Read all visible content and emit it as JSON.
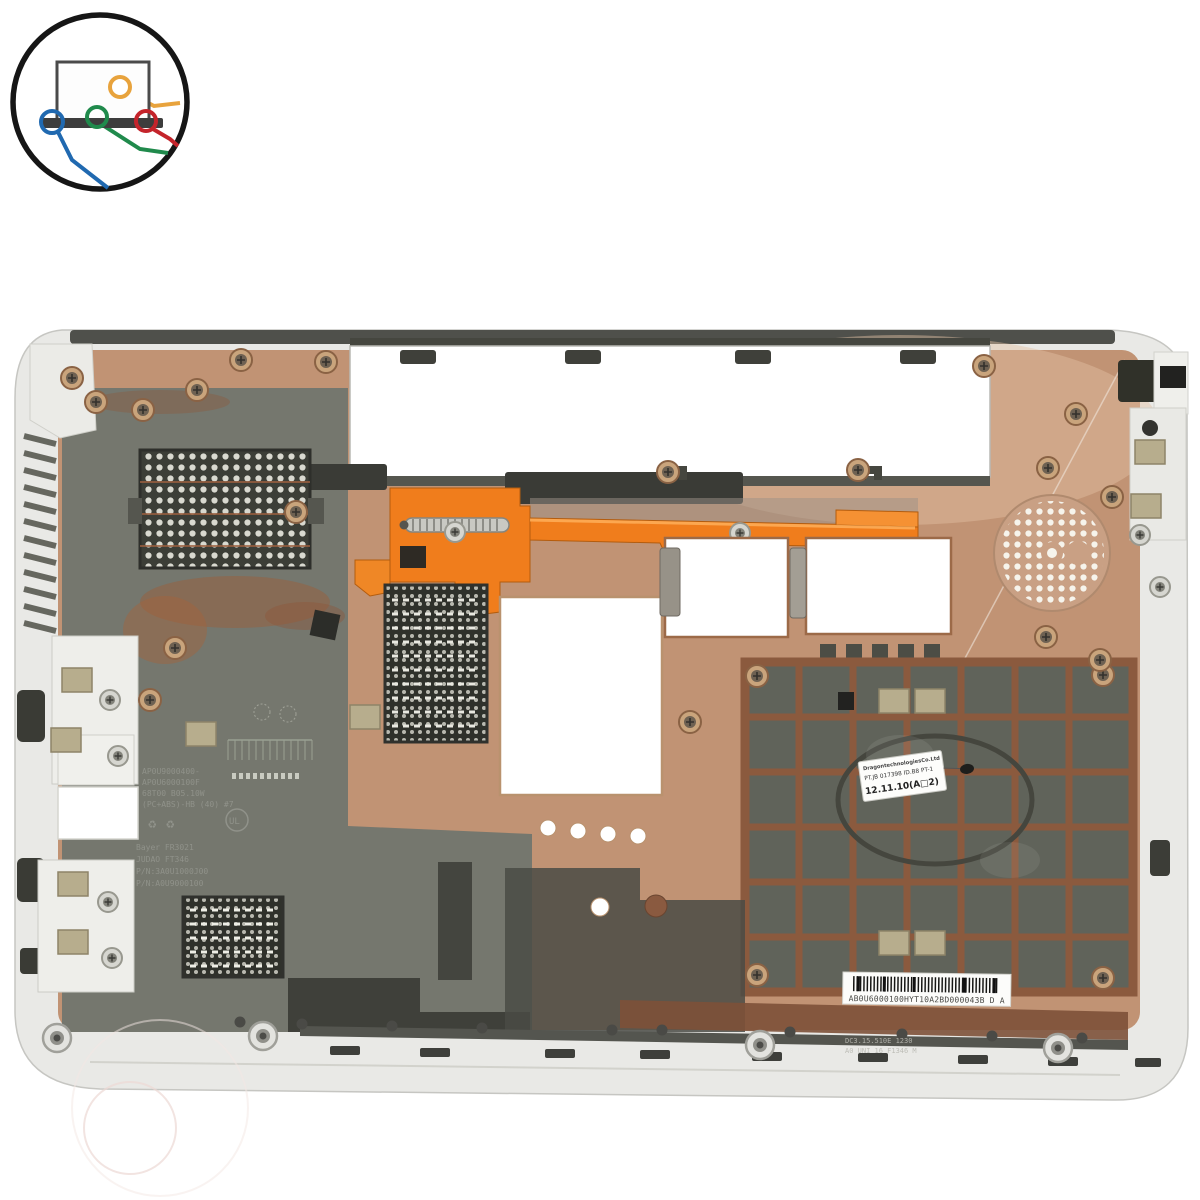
{
  "background_color": "#ffffff",
  "logo": {
    "circle_color": "#161616",
    "laptop_outline_color": "#4a4a4a",
    "base_color": "#3d3d3d",
    "cables": {
      "orange": "#e8a33d",
      "blue": "#2069b0",
      "green": "#208a4c",
      "red": "#c4242b"
    }
  },
  "photo": {
    "subject": "Laptop bottom base cover, inside view",
    "colors": {
      "case_white": "#e9e9e6",
      "interior_copper": "#c19374",
      "interior_dark": "#75776e",
      "latch_orange": "#f07d1c",
      "grid_brown": "#8b5a3e",
      "grid_panel": "#60635a",
      "vent_dark": "#35372f",
      "top_lip_dark": "#4f504b"
    }
  },
  "labels": {
    "sticker": {
      "line1": "DragontechnologiesCo.Ltd",
      "line2": "PT.JB  017398  ID.B8  PT-1",
      "line3": "12.11.10(A□2)"
    },
    "barcode_text": "AB0U6000100HYT10A2BD000043B  D A",
    "molded": {
      "lines": [
        "AP0U9000400-",
        "AP0U6000100F",
        "68T00  B05.10W",
        "(PC+ABS)-HB (40)  #7",
        "Bayer  FR3021",
        "JUDAO  FT346",
        "P/N:3A0U1000J00",
        "P/N:A0U9000100"
      ]
    },
    "rim": {
      "line1": "DC3.15.510E  1230",
      "line2": "A0 UNI 16 F1346  M"
    },
    "icons": {
      "recycle": "♻",
      "ul": "UL"
    }
  }
}
